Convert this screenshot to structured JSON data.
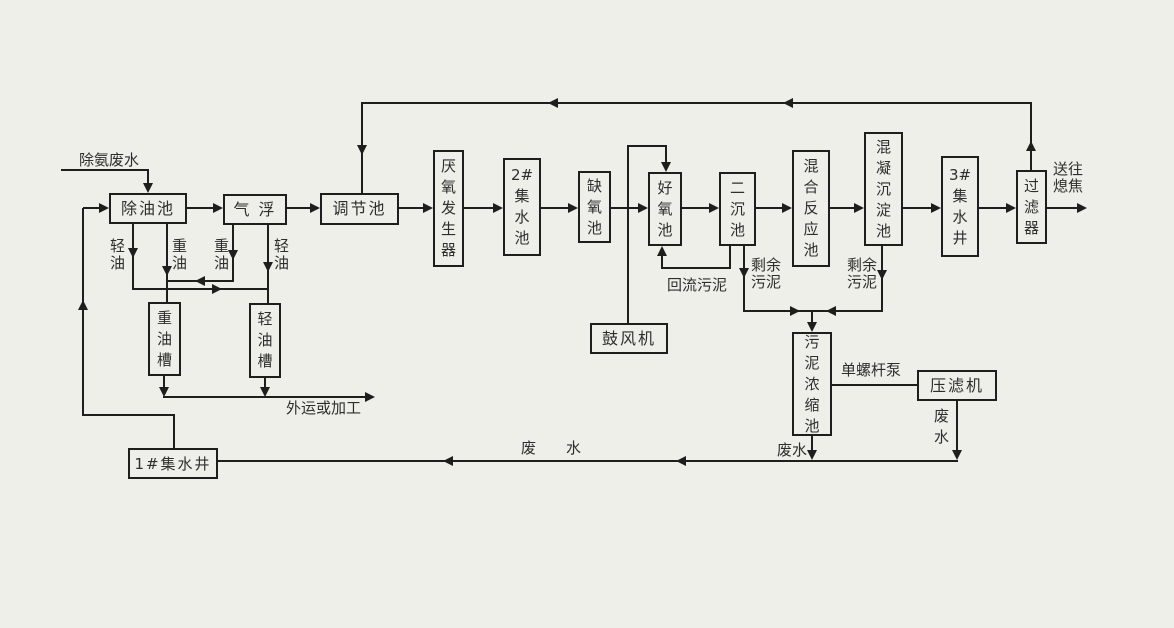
{
  "diagram": {
    "colors": {
      "background": "#edefe8",
      "line": "#1e1e1e",
      "text": "#2e2e2e"
    },
    "nodes": {
      "oil_removal": "除油池",
      "air_flotation": "气 浮",
      "equalization": "调节池",
      "anaerobic_generator": "厌\n氧\n发\n生\n器",
      "collection_pool_2": "2#\n集\n水\n池",
      "anoxic_pool": "缺\n氧\n池",
      "aerobic_pool": "好\n氧\n池",
      "secondary_clarifier": "二\n沉\n池",
      "mixing_reaction_pool": "混\n合\n反\n应\n池",
      "coagulation_sedimentation_pool": "混\n凝\n沉\n淀\n池",
      "collection_well_3": "3#\n集\n水\n井",
      "filter": "过\n滤\n器",
      "heavy_oil_tank": "重\n油\n槽",
      "light_oil_tank": "轻\n油\n槽",
      "collection_well_1": "1#集水井",
      "blower": "鼓风机",
      "sludge_thickener": "污\n泥\n浓\n缩\n池",
      "filter_press": "压滤机"
    },
    "labels": {
      "feed": "除氨废水",
      "light_oil_left": "轻\n油",
      "heavy_oil_left": "重\n油",
      "heavy_oil_right": "重\n油",
      "light_oil_right": "轻\n油",
      "transport_or_processing": "外运或加工",
      "return_sludge": "回流污泥",
      "excess_sludge_left": "剩余\n污泥",
      "excess_sludge_right": "剩余\n污泥",
      "screw_pump": "单螺杆泵",
      "wastewater_thickener": "废水",
      "wastewater_press": "废\n水",
      "wastewater_bottom": "废水",
      "to_coke_quenching": "送往\n熄焦"
    }
  }
}
